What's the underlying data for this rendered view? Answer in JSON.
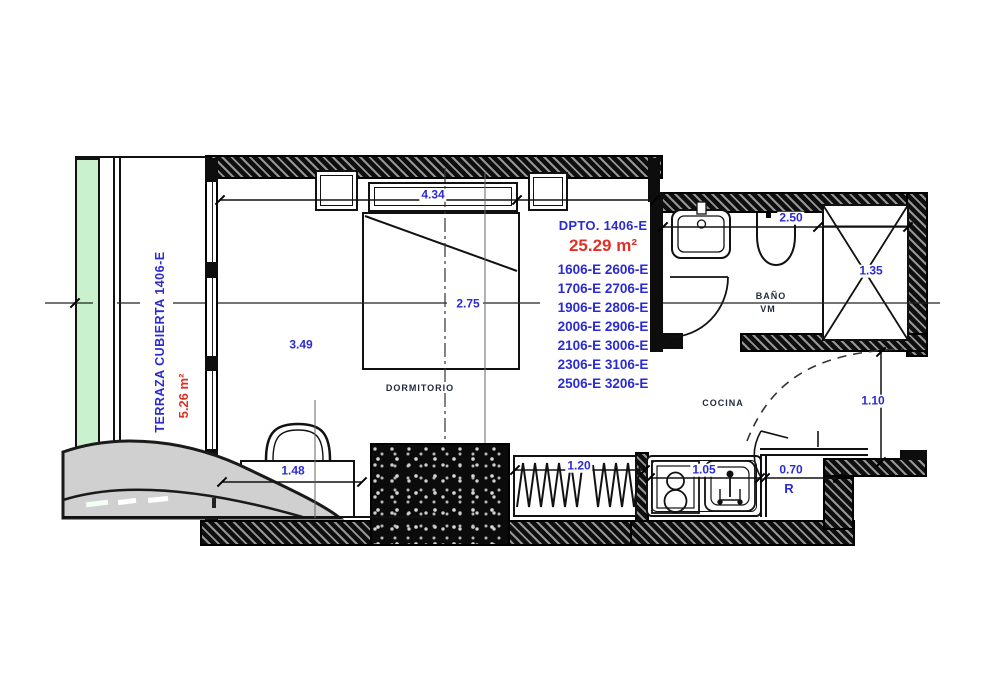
{
  "plan": {
    "terrace": {
      "label": "TERRAZA CUBIERTA 1406-E",
      "area": "5.26 m²"
    },
    "unit": {
      "title": "DPTO. 1406-E",
      "area": "25.29 m²",
      "stack": [
        "1606-E 2606-E",
        "1706-E 2706-E",
        "1906-E 2806-E",
        "2006-E 2906-E",
        "2106-E 3006-E",
        "2306-E 3106-E",
        "2506-E 3206-E"
      ]
    },
    "rooms": {
      "bedroom": "DORMITORIO",
      "kitchen": "COCINA",
      "bath_line1": "BAÑO",
      "bath_line2": "VM",
      "fridge": "R"
    },
    "dimensions": {
      "bedroom_width": "4.34",
      "bedroom_depth": "3.49",
      "bed_center": "2.75",
      "desk": "1.48",
      "closet": "1.20",
      "counter": "1.05",
      "fridge_nook": "0.70",
      "entry": "1.10",
      "bath_width": "2.50",
      "shower": "1.35"
    },
    "colors": {
      "label_blue": "#2b2bd4",
      "area_red": "#e03224",
      "room_navy": "#212b3d",
      "terrace_green": "#c9f1cd",
      "wall_black": "#0d0d0d"
    }
  }
}
